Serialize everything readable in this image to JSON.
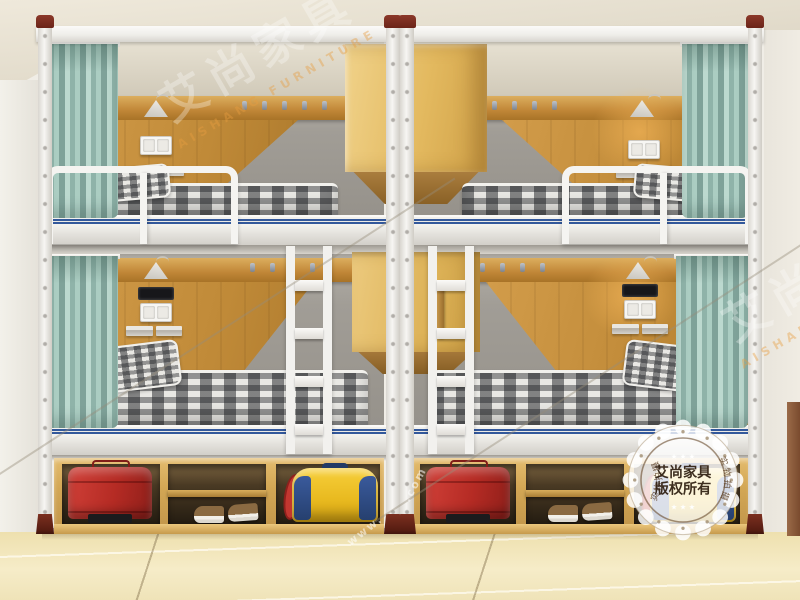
{
  "image_type": "product photograph",
  "subject": "dormitory double bunk beds with privacy curtains, wall lamps, sockets, ladders and under-bed storage cubbies",
  "watermarks": {
    "brand_cn": "艾尚家具",
    "brand_en": "AISHANG FURNITURE",
    "domain_prefix": "www.",
    "domain_suffix": ".com",
    "stamp": {
      "line1": "艾尚家具",
      "line2": "版权所有",
      "side_text": "实物拍摄",
      "stars_top": "★ ★ ★",
      "stars_bottom": "★ ★ ★"
    }
  },
  "palette": {
    "frame_white": "#f4f3f0",
    "post_cap_maroon": "#7b2e20",
    "wood_panel": "#c8913f",
    "cabinet_wood": "#e7c277",
    "storage_wood": "#d9af60",
    "curtain_teal": "#9fc6bb",
    "wall_gray": "#9e9a93",
    "ceiling_cream": "#e8e2d4",
    "floor_beige": "#f0e3b4",
    "accent_stripe_blue": "#33589b",
    "pillow_yellow": "#e7b23a",
    "suitcase_red": "#bd2f27",
    "bag_yellow": "#f2c31e",
    "bag_blue": "#2e4e8e"
  },
  "scene_objects": [
    "bunk-bed-unit-left",
    "bunk-bed-unit-right",
    "privacy-curtains",
    "wall-lamps",
    "power-outlets",
    "wall-shelves",
    "coat-hook-pegs",
    "ladders",
    "hanging-cabinets",
    "storage-cubbies",
    "suitcases",
    "shoes",
    "duffel-bags",
    "tiled-floor"
  ]
}
